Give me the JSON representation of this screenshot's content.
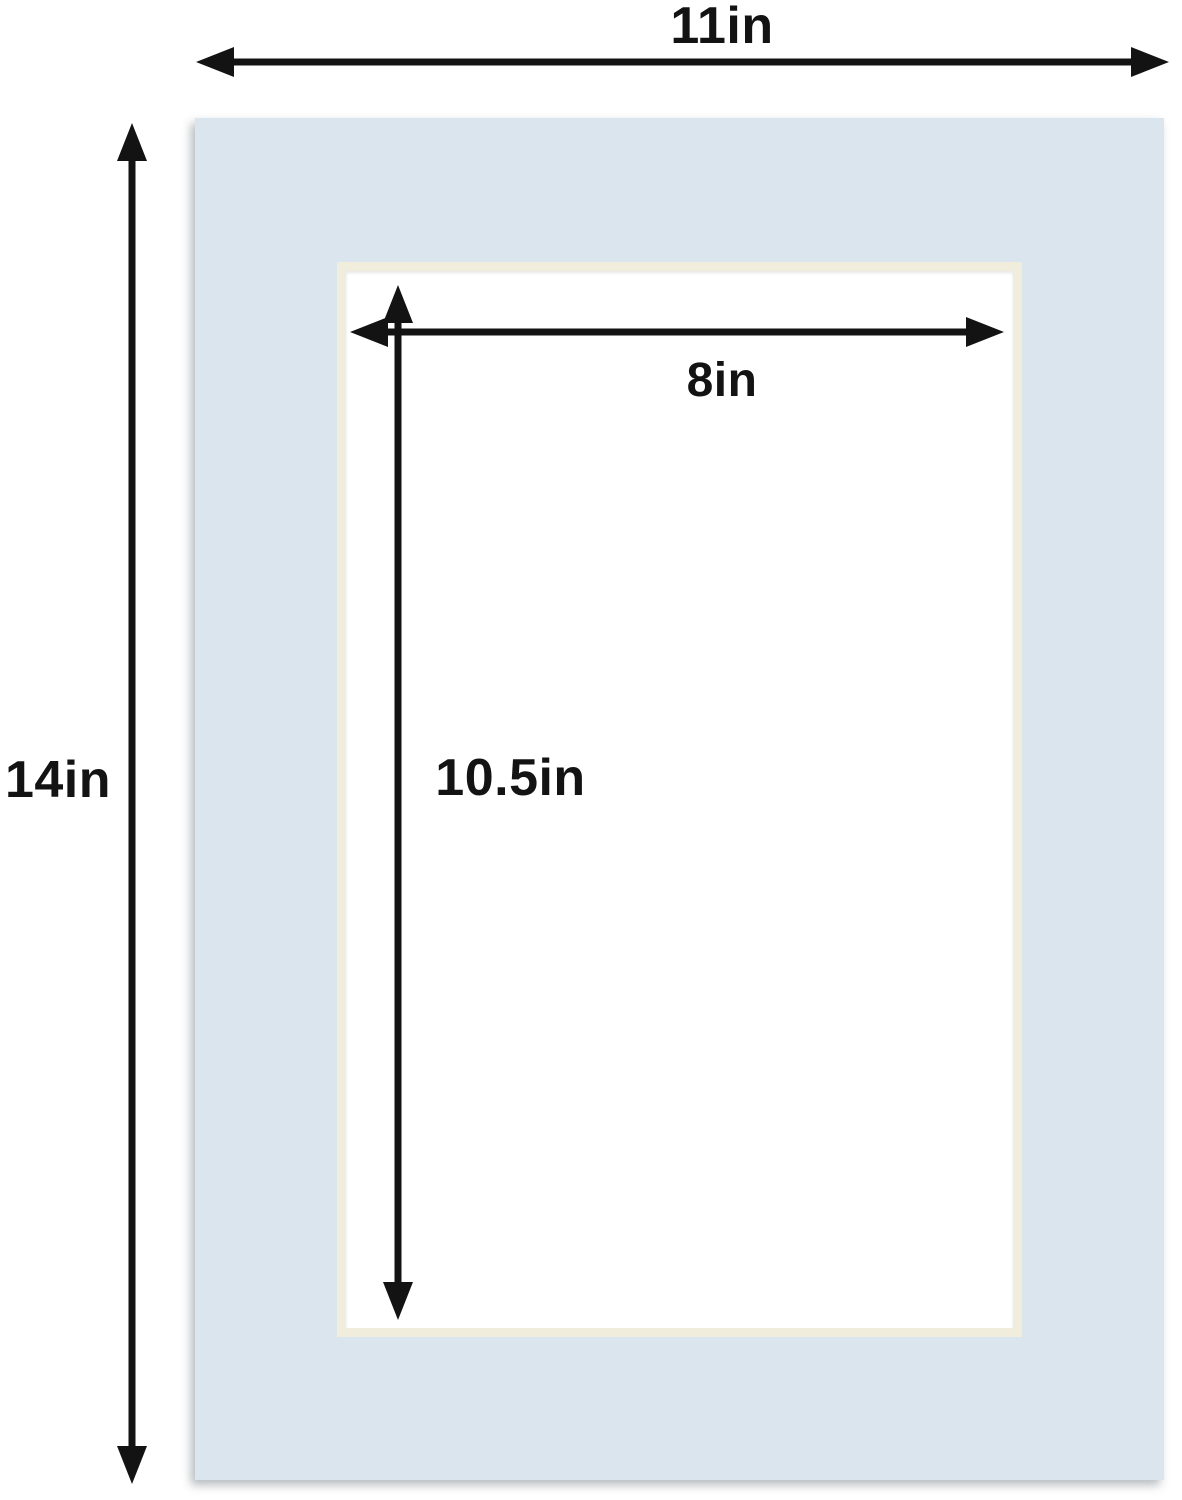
{
  "dimensions": {
    "overall_width": "11in",
    "overall_height": "14in",
    "opening_width": "8in",
    "opening_height": "10.5in"
  },
  "colors": {
    "background": "#FFFFFF",
    "mat": "#DAE5ED",
    "bevel": "#F1EDDC",
    "opening": "#FFFFFF",
    "arrow": "#131313"
  }
}
